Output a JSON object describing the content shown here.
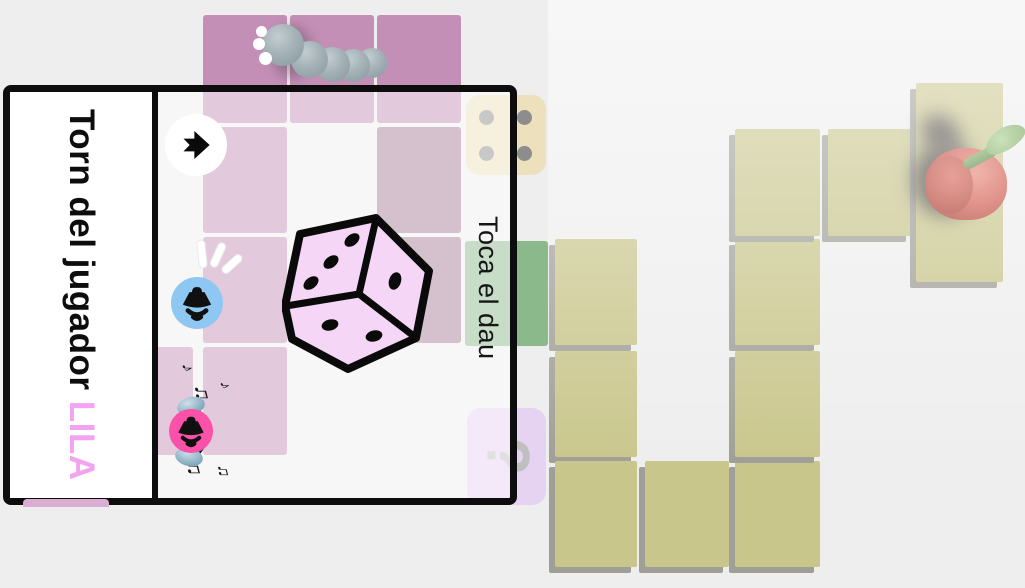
{
  "app": {
    "background": "#eeeeee"
  },
  "panel": {
    "title_prefix": "Torn del jugador ",
    "player_name": "LILA",
    "player_color": "#f2a4f0",
    "instruction": "Toca el dau"
  },
  "dice": {
    "color": "#f5d6f6",
    "visible_faces": {
      "top": 3,
      "right": 1,
      "front": 2
    }
  },
  "die_icon_tile": {
    "face_value": 4
  },
  "board": {
    "question_mark": "?",
    "tiles": [
      {
        "x": 203,
        "y": 15,
        "w": 84,
        "h": 108,
        "kind": "pink"
      },
      {
        "x": 290,
        "y": 15,
        "w": 84,
        "h": 108,
        "kind": "pink"
      },
      {
        "x": 377,
        "y": 15,
        "w": 84,
        "h": 108,
        "kind": "pink"
      },
      {
        "x": 203,
        "y": 127,
        "w": 84,
        "h": 106,
        "kind": "pink"
      },
      {
        "x": 203,
        "y": 237,
        "w": 84,
        "h": 106,
        "kind": "pink"
      },
      {
        "x": 110,
        "y": 347,
        "w": 83,
        "h": 108,
        "kind": "pink"
      },
      {
        "x": 203,
        "y": 347,
        "w": 84,
        "h": 108,
        "kind": "pink"
      },
      {
        "x": 377,
        "y": 127,
        "w": 84,
        "h": 106,
        "kind": "plum"
      },
      {
        "x": 377,
        "y": 237,
        "w": 84,
        "h": 106,
        "kind": "plum"
      },
      {
        "x": 466,
        "y": 95,
        "w": 80,
        "h": 80,
        "kind": "cream-die"
      },
      {
        "x": 465,
        "y": 241,
        "w": 83,
        "h": 105,
        "kind": "green"
      },
      {
        "x": 467,
        "y": 408,
        "w": 79,
        "h": 97,
        "kind": "question"
      },
      {
        "x": 555,
        "y": 239,
        "w": 82,
        "h": 106,
        "kind": "khaki"
      },
      {
        "x": 555,
        "y": 351,
        "w": 82,
        "h": 106,
        "kind": "khaki"
      },
      {
        "x": 555,
        "y": 461,
        "w": 82,
        "h": 106,
        "kind": "khaki"
      },
      {
        "x": 645,
        "y": 461,
        "w": 84,
        "h": 106,
        "kind": "khaki"
      },
      {
        "x": 735,
        "y": 461,
        "w": 85,
        "h": 106,
        "kind": "khaki"
      },
      {
        "x": 735,
        "y": 351,
        "w": 85,
        "h": 106,
        "kind": "khaki"
      },
      {
        "x": 735,
        "y": 239,
        "w": 85,
        "h": 106,
        "kind": "khaki"
      },
      {
        "x": 735,
        "y": 129,
        "w": 85,
        "h": 107,
        "kind": "khaki"
      },
      {
        "x": 828,
        "y": 129,
        "w": 84,
        "h": 107,
        "kind": "khaki"
      },
      {
        "x": 916,
        "y": 83,
        "w": 87,
        "h": 199,
        "kind": "khaki"
      }
    ]
  },
  "music_notes": [
    {
      "x": 173,
      "y": 266,
      "glyph": "♪",
      "size": 17
    },
    {
      "x": 184,
      "y": 288,
      "glyph": "♫",
      "size": 22
    },
    {
      "x": 211,
      "y": 285,
      "glyph": "♪",
      "size": 15
    },
    {
      "x": 176,
      "y": 363,
      "glyph": "♫",
      "size": 22
    },
    {
      "x": 207,
      "y": 369,
      "glyph": "♫",
      "size": 17
    }
  ],
  "icons": [
    "arrow-right-icon",
    "speaker-icon",
    "speaker-headphones-icon",
    "dice-3d",
    "die-face-4",
    "question-mark",
    "caterpillar",
    "apple"
  ],
  "colors": {
    "tile_pink": "#c48fb6",
    "tile_plum": "#a87e9a",
    "tile_cream": "#ece0bd",
    "tile_green": "#8bb98b",
    "tile_lavender": "#e6d2f1",
    "tile_khaki": "#c9c68c",
    "khaki_shadow": "#a09f97",
    "speaker_blue": "#8ec7f2",
    "speaker_pink": "#fb51a8",
    "dice_face": "#f5d6f6"
  }
}
